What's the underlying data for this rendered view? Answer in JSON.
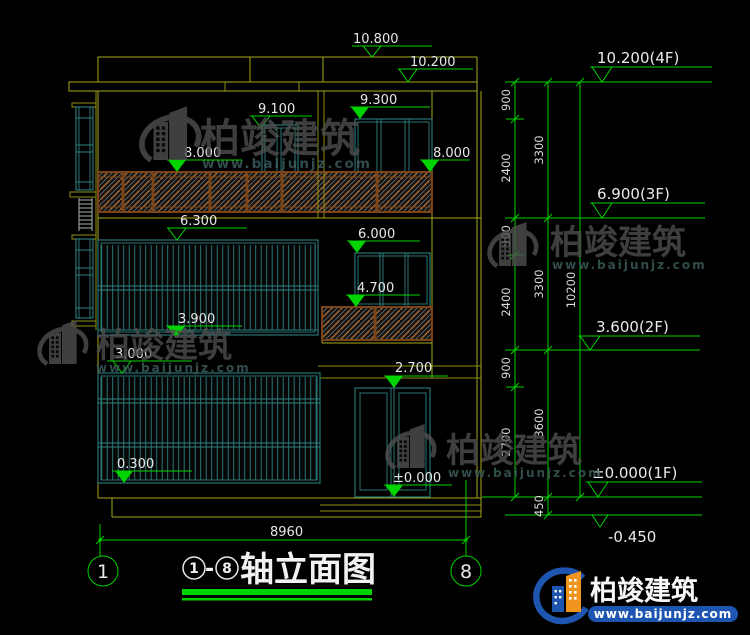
{
  "drawing": {
    "elevation_markers": [
      {
        "value": "10.800"
      },
      {
        "value": "10.200"
      },
      {
        "value": "9.100"
      },
      {
        "value": "9.300"
      },
      {
        "value": "8.000"
      },
      {
        "value": "8.000"
      },
      {
        "value": "6.300"
      },
      {
        "value": "6.000"
      },
      {
        "value": "4.700"
      },
      {
        "value": "3.900"
      },
      {
        "value": "3.000"
      },
      {
        "value": "2.700"
      },
      {
        "value": "0.300"
      },
      {
        "value": "±0.000"
      }
    ],
    "floor_markers": [
      {
        "value": "10.200(4F)"
      },
      {
        "value": "6.900(3F)"
      },
      {
        "value": "3.600(2F)"
      },
      {
        "value": "±0.000(1F)"
      },
      {
        "value": "-0.450"
      }
    ],
    "dims_inner": [
      "900",
      "2400",
      "900",
      "2400",
      "900",
      "2700"
    ],
    "dims_mid": [
      "3300",
      "3300",
      "3600",
      "450"
    ],
    "dim_total": "10200",
    "dim_width": "8960",
    "axis_left": "1",
    "axis_right": "8"
  },
  "title_block": {
    "axis_start": "1",
    "separator": "-",
    "axis_end": "8",
    "title": "轴立面图"
  },
  "watermark": {
    "name": "柏竣建筑",
    "url": "www.baijunjz.com"
  },
  "logo": {
    "name": "柏竣建筑",
    "url": "www.baijunjz.com"
  },
  "colors": {
    "background": "#000000",
    "outline_yellow": "#a8a818",
    "frame_teal": "#2d8080",
    "dimension_green": "#00d400",
    "text_white": "#e8e8e8",
    "rail_brown": "#7a4418",
    "logo_blue": "#1d55b0",
    "logo_orange": "#f0941e"
  }
}
